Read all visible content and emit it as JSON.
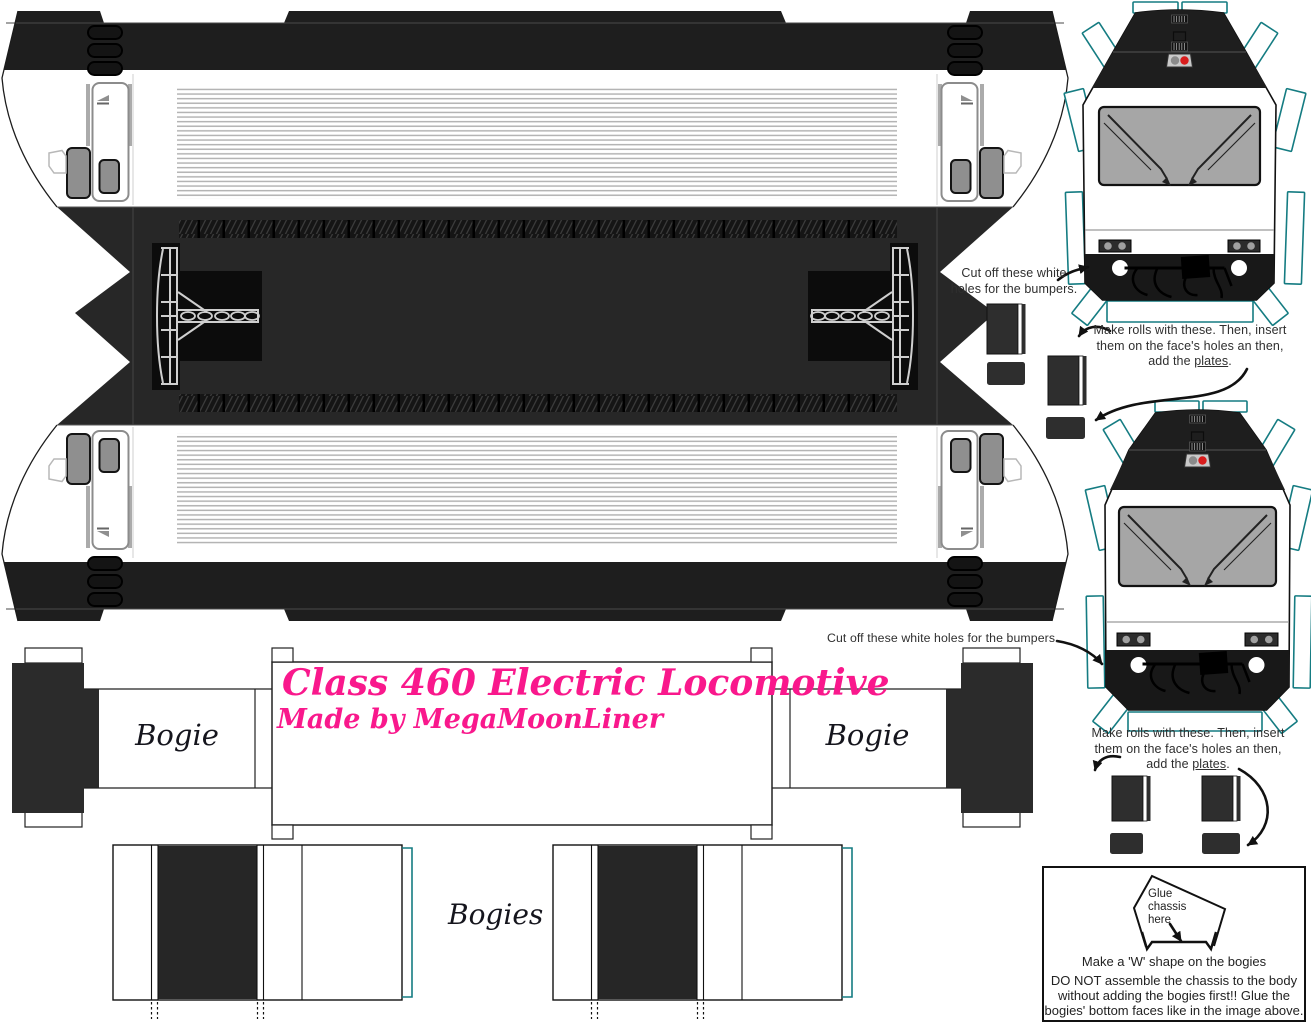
{
  "sheet": {
    "title_line1": "Class 460 Electric Locomotive",
    "title_line2": "Made by MegaMoonLiner",
    "bogie_label_left": "Bogie",
    "bogie_label_right": "Bogie",
    "bogies_label": "Bogies"
  },
  "notes": {
    "bumpers_top": "Cut off these white holes for the bumpers.",
    "bumpers_bottom": "Cut off these white holes for the bumpers.",
    "rolls_line1": "Make rolls with these. Then, insert",
    "rolls_line2": "them on the face's holes an then,",
    "rolls_line3_pre": "add the ",
    "rolls_line3_underlined": "plates",
    "rolls_line3_post": "."
  },
  "instruction_box": {
    "glue_label": "Glue\nchassis\nhere",
    "w_shape_line": "Make a 'W' shape on the bogies",
    "warning_lines": [
      "DO NOT assemble the chassis to the body",
      "without adding the bogies first!! Glue the",
      "bogies' bottom faces like in the image above."
    ]
  },
  "colors": {
    "ink": "#111111",
    "note_ink": "#2f2f2f",
    "script_ink": "#15151d",
    "title_pink": "#f9188c",
    "band_black": "#1e1e1e",
    "roof_gray": "#272727",
    "panel_black": "#0c0c0c",
    "pantograph_line": "#cfcfcf",
    "grille_line": "#b4b4b4",
    "hatch_bg": "#151515",
    "hatch_line": "#3a3a3a",
    "window_gray": "#8f8f8f",
    "windshield_gray": "#a6a6a6",
    "tab_teal": "#157c82",
    "part_dark": "#2e2e2e",
    "bogie_olive": "#5c5b40",
    "bogie_dark_olive": "#3c3d28",
    "bogie_gray": "#9e9e9e",
    "bogie_steel": "#55565a",
    "red_light": "#d81c1c"
  }
}
